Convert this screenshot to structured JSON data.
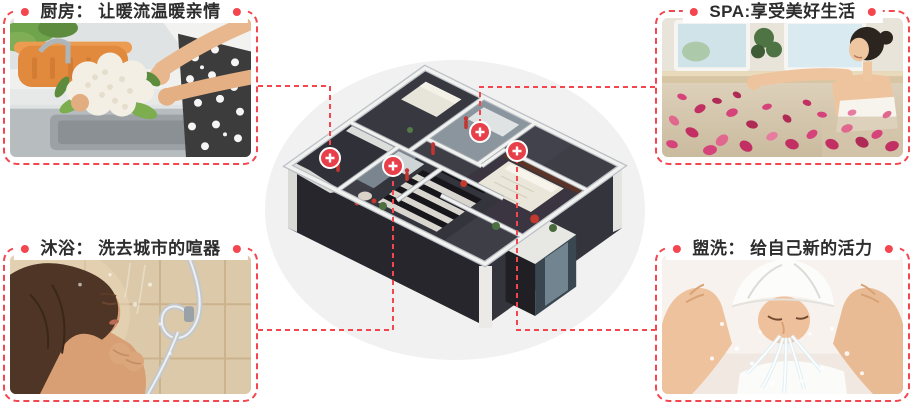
{
  "canvas": {
    "width": 913,
    "height": 408,
    "background": "#ffffff"
  },
  "theme": {
    "accent_red": "#f3464e",
    "marker_red": "#e8404a",
    "label_color": "#2d2d2d"
  },
  "callouts": [
    {
      "id": "kitchen",
      "position": "top-left",
      "label": "厨房： 让暖流温暖亲情",
      "scene": "hands washing a cauliflower at a kitchen sink"
    },
    {
      "id": "spa",
      "position": "top-right",
      "label": "SPA:享受美好生活",
      "scene": "woman relaxing in a rose-petal bath"
    },
    {
      "id": "shower",
      "position": "bottom-left",
      "label": "沐浴： 洗去城市的喧器",
      "scene": "woman taking a warm shower"
    },
    {
      "id": "wash",
      "position": "bottom-right",
      "label": "盥洗： 给自己新的活力",
      "scene": "person with towel on head splashing water on face"
    }
  ],
  "floorplan": {
    "description": "isometric 3D cutaway apartment model",
    "hotspots": [
      {
        "room": "kitchen"
      },
      {
        "room": "shower"
      },
      {
        "room": "spa"
      },
      {
        "room": "wash"
      }
    ]
  }
}
